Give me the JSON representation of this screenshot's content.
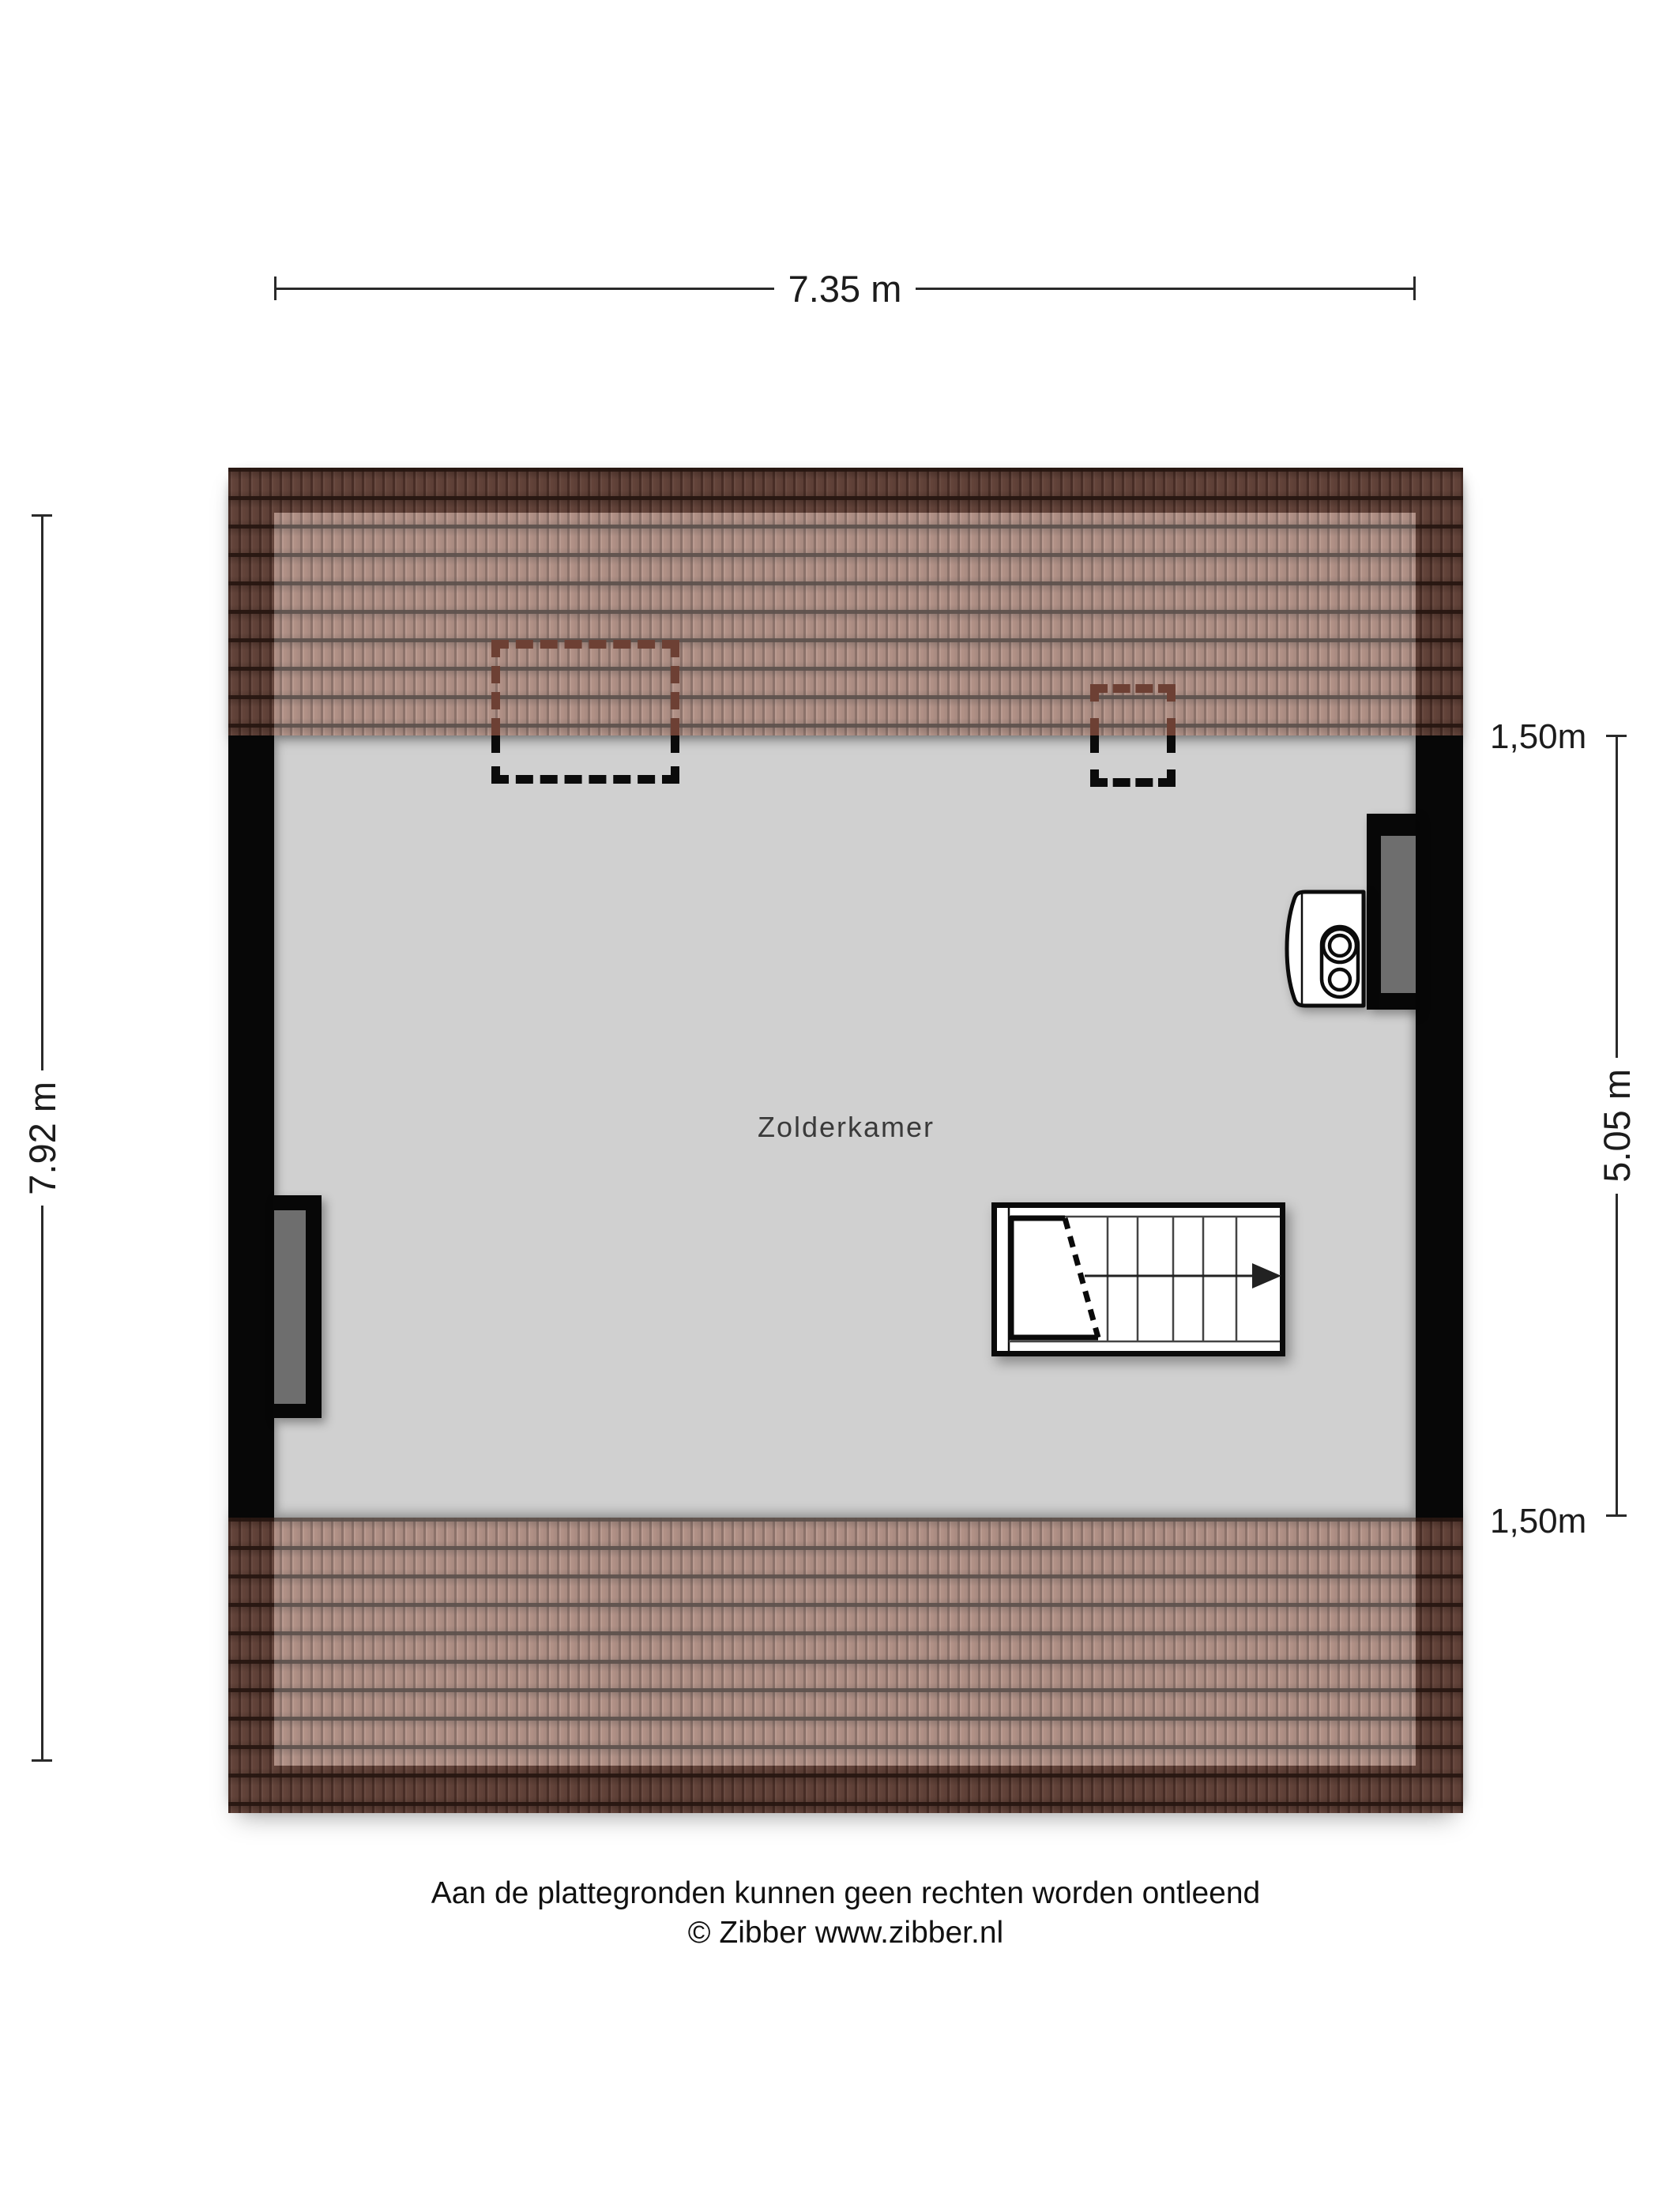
{
  "plan": {
    "room_label": "Zolderkamer"
  },
  "dimensions": {
    "width_label": "7.35 m",
    "left_depth_label": "7.92 m",
    "right_depth_label": "5.05 m",
    "knee_wall_top_label": "1,50m",
    "knee_wall_bottom_label": "1,50m"
  },
  "footer": {
    "disclaimer": "Aan de plattegronden kunnen geen rechten worden ontleend",
    "copyright": "© Zibber www.zibber.nl"
  },
  "icons": {
    "boiler": "boiler-icon",
    "stairs_direction": "arrow-right-icon"
  },
  "colors": {
    "background": "#ffffff",
    "floor": "#d0d0d0",
    "wall": "#070707",
    "tile_base": "#9b7062",
    "roof_overhang_shade": "rgba(33,16,10,0.45)",
    "roof_interior_light": "rgba(255,255,255,0.24)",
    "window_pane": "#6e6e6e",
    "skylight_dash_on_roof": "#6d4034",
    "skylight_dash_on_floor": "#0b0b0b",
    "dimension_ink": "#2a2a2a"
  }
}
